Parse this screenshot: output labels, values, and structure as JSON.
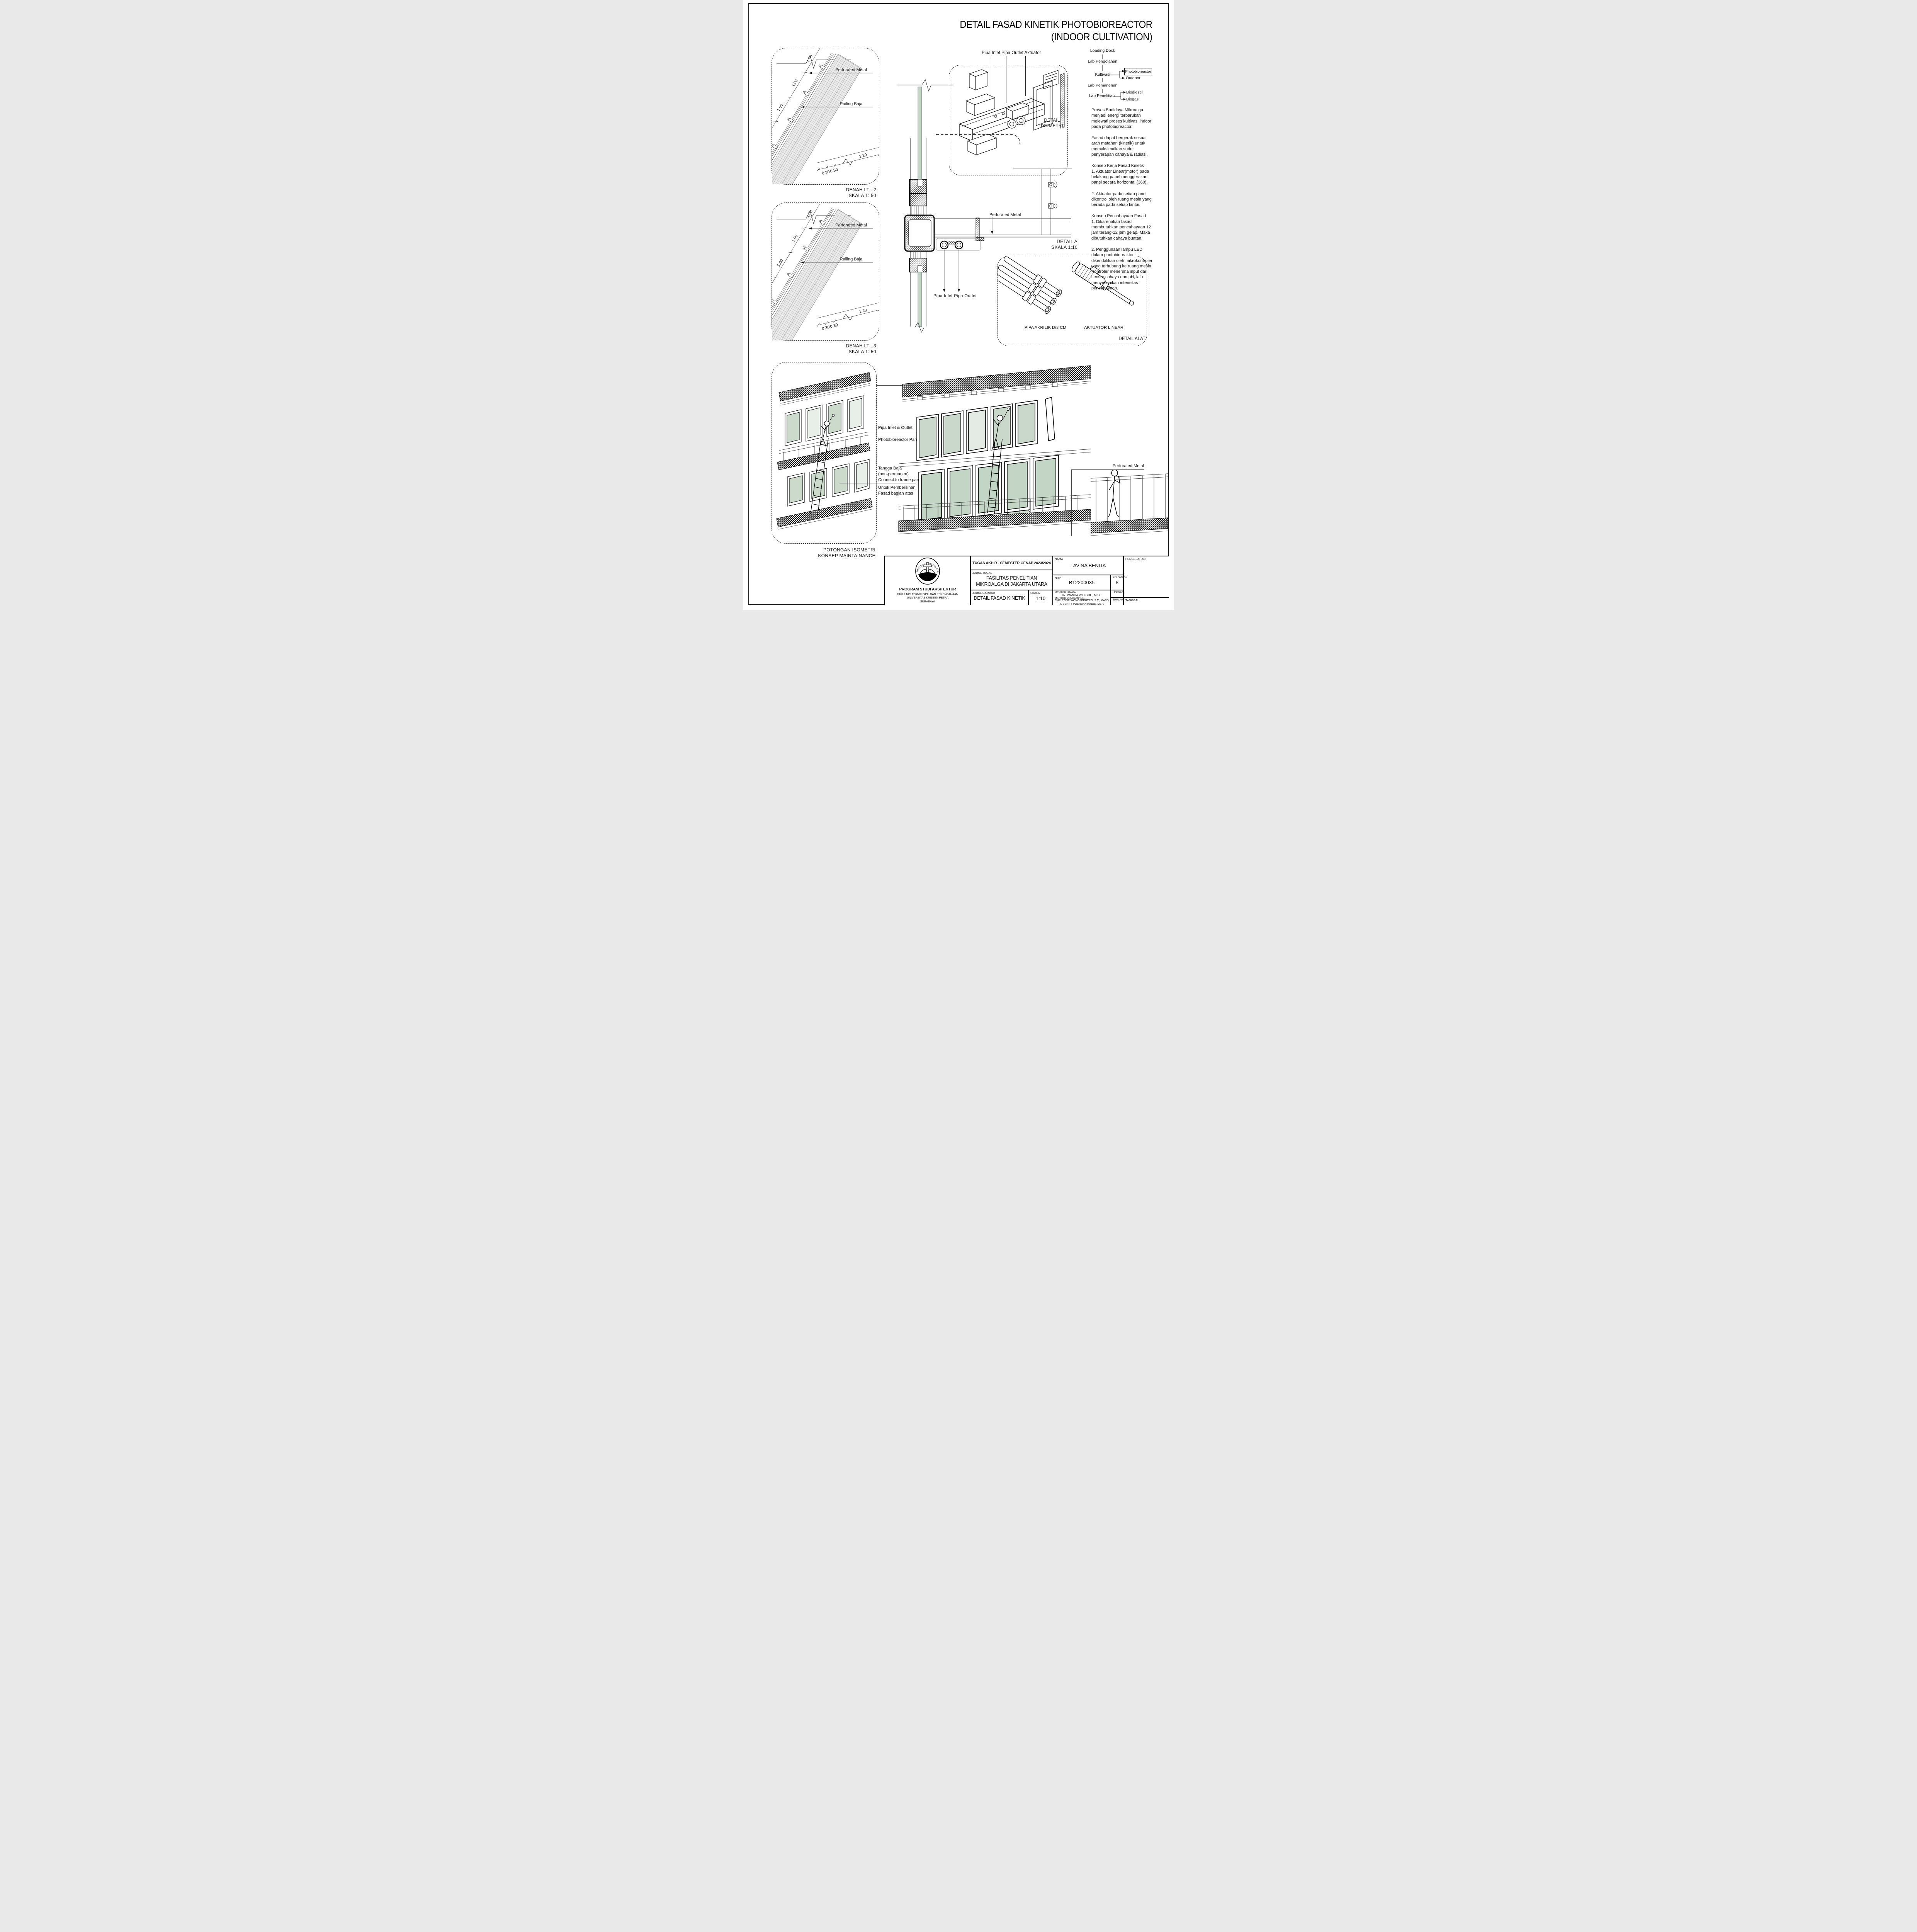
{
  "title": {
    "line1": "DETAIL FASAD KINETIK PHOTOBIOREACTOR",
    "line2": "(INDOOR CULTIVATION)"
  },
  "flowchart": {
    "loading_dock": "Loading Dock",
    "lab_pengolahan": "Lab Pengolahan",
    "kultivasi": "Kultivasi",
    "photobioreactor": "Photobioreactor",
    "outdoor": "Outdoor",
    "lab_pemanenan": "Lab Pemanenan",
    "lab_penelitian": "Lab Penelitian",
    "biodiesel": "Biodiesel",
    "biogas": "Biogas"
  },
  "paragraphs": {
    "p1": "Proses Budidaya Mikroalga menjadi energi terbarukan melewati proses kultivasi indoor pada photobioreactor.",
    "p2": "Fasad dapat bergerak sesuai arah matahari (kinetik) untuk memaksimalkan sudut penyerapan cahaya & radiasi.",
    "p3_title": "Konsep Kerja Fasad Kinetik",
    "p3": "1. Aktuator Linear(motor) pada belakang panel menggerakan panel secara horizontal (360).",
    "p4": "2. Aktuator pada setiap panel dikontrol oleh ruang mesin yang berada pada setiap lantai.",
    "p5_title": "Konsep Pencahayaan Fasad",
    "p5": "1. Dikarenakan fasad membutuhkan pencahayaan 12 jam terang-12 jam gelap. Maka dibutuhkan cahaya buatan.",
    "p6": "2. Penggunaan lampu LED dalam photobioreaktor dikendalikan oleh mikrokontroler yang terhubung ke ruang mesin. Kontroler menerima input dari sensor cahaya dan pH, lalu menyesuaikan intensitas pencahayaan."
  },
  "denah2": {
    "caption_line1": "DENAH  LT . 2",
    "caption_line2": "SKALA 1: 50",
    "label_perforated": "Perforated Metal",
    "label_railing": "Railing Baja",
    "dims": [
      "1.00",
      "1.00",
      "1.00",
      "1.00"
    ],
    "dims_bottom": [
      "0.30",
      "0.30",
      "1.20"
    ]
  },
  "denah3": {
    "caption_line1": "DENAH  LT . 3",
    "caption_line2": "SKALA 1: 50",
    "label_perforated": "Perforated Metal",
    "label_railing": "Railing Baja",
    "dims": [
      "1.00",
      "1.00",
      "1.00",
      "1.00"
    ],
    "dims_bottom": [
      "0.30",
      "0.30",
      "1.20"
    ]
  },
  "detail_isometri": {
    "top_labels": "Pipa Inlet  Pipa Outlet  Aktuator",
    "caption_line1": "DETAIL",
    "caption_line2": "ISOMETRI"
  },
  "detail_a": {
    "label_perforated": "Perforated Metal",
    "pipe_labels": "Pipa Inlet  Pipa Outlet",
    "caption_line1": "DETAIL A",
    "caption_line2": "SKALA 1:10"
  },
  "detail_alat": {
    "pipa_label": "PIPA AKRILIK  D/3 CM",
    "aktuator_label": "AKTUATOR LINEAR",
    "caption": "DETAIL ALAT"
  },
  "potongan": {
    "caption_line1": "POTONGAN ISOMETRI",
    "caption_line2": "KONSEP MAINTAINANCE",
    "label_pipa": "Pipa Inlet & Outlet",
    "label_panel": "Photobioreactor Panel",
    "label_tangga_1": "Tangga Baja",
    "label_tangga_2": "(non-permanen)",
    "label_tangga_3": "Connect to frame panel",
    "label_untuk_1": "Untuk Pembersihan",
    "label_untuk_2": "Fasad bagian atas",
    "label_perforated": "Perforated Metal"
  },
  "titleblock": {
    "header": "TUGAS AKHIR - SEMESTER GENAP 2023/2024",
    "judul_tugas_label": "JUDUL TUGAS",
    "judul_tugas_1": "FASILITAS PENELITIAN",
    "judul_tugas_2": "MIKROALGA DI JAKARTA UTARA",
    "judul_gambar_label": "JUDUL GAMBAR",
    "judul_gambar": "DETAIL FASAD KINETIK",
    "skala_label": "SKALA",
    "skala": "1:10",
    "nama_label": "NAMA",
    "nama": "LAVINA BENITA",
    "nrp_label": "NRP",
    "nrp": "B12200035",
    "kelompok_label": "KELOMPOK",
    "kelompok": "8",
    "lembar_label": "LEMBAR",
    "jumlah_label": "JUMLAH",
    "pengesahan_label": "PENGESAHAN",
    "tanggal_label": "TANGGAL",
    "mentor_utama_label": "MENTOR UTAMA",
    "mentor_utama": "IR. WANDA WIDIGDO, M.SI.",
    "mentor_pendamping_label": "MENTOR PENDAMPING",
    "mentor_pendamping_1": "CHRISTINE WONOSEPUTRO, S.T., MASD",
    "mentor_pendamping_2": "Ir. BENNY POERBANTANOE, MSP.",
    "inst_1": "PROGRAM STUDI ARSITEKTUR",
    "inst_2": "FAKULTAS TEKNIK SIPIL DAN PERENCANAAN",
    "inst_3": "UNIVERSITAS KRISTEN PETRA",
    "inst_4": "SURABAYA",
    "logo_top": "UNIVERSITAS KRISTEN",
    "logo_bottom": "PETRA"
  },
  "colors": {
    "panel_green": "#c3d5c4",
    "line_black": "#111111"
  }
}
